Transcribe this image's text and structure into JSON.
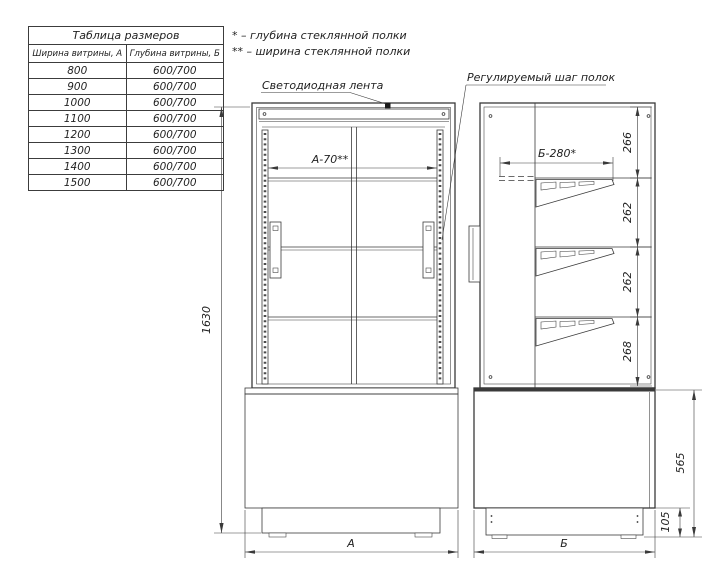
{
  "table": {
    "title": "Таблица размеров",
    "col_a": "Ширина витрины, А",
    "col_b": "Глубина витрины, Б",
    "rows": [
      {
        "a": "800",
        "b": "600/700"
      },
      {
        "a": "900",
        "b": "600/700"
      },
      {
        "a": "1000",
        "b": "600/700"
      },
      {
        "a": "1100",
        "b": "600/700"
      },
      {
        "a": "1200",
        "b": "600/700"
      },
      {
        "a": "1300",
        "b": "600/700"
      },
      {
        "a": "1400",
        "b": "600/700"
      },
      {
        "a": "1500",
        "b": "600/700"
      }
    ]
  },
  "legend": {
    "line1": "* – глубина стеклянной полки",
    "line2": "** – ширина стеклянной полки"
  },
  "callouts": {
    "led_strip": "Светодиодная лента",
    "shelf_pitch": "Регулируемый шаг полок"
  },
  "dimensions": {
    "overall_height": "1630",
    "shelf_width": "А-70**",
    "shelf_depth": "Б-280*",
    "front_width": "А",
    "side_depth": "Б",
    "base_height": "565",
    "plinth_height": "105",
    "shelf_gaps": [
      "266",
      "262",
      "262",
      "268"
    ]
  },
  "colors": {
    "line": "#3a3a3a",
    "led_band": "#d8d8d8",
    "corrugation": "#cccccc"
  }
}
